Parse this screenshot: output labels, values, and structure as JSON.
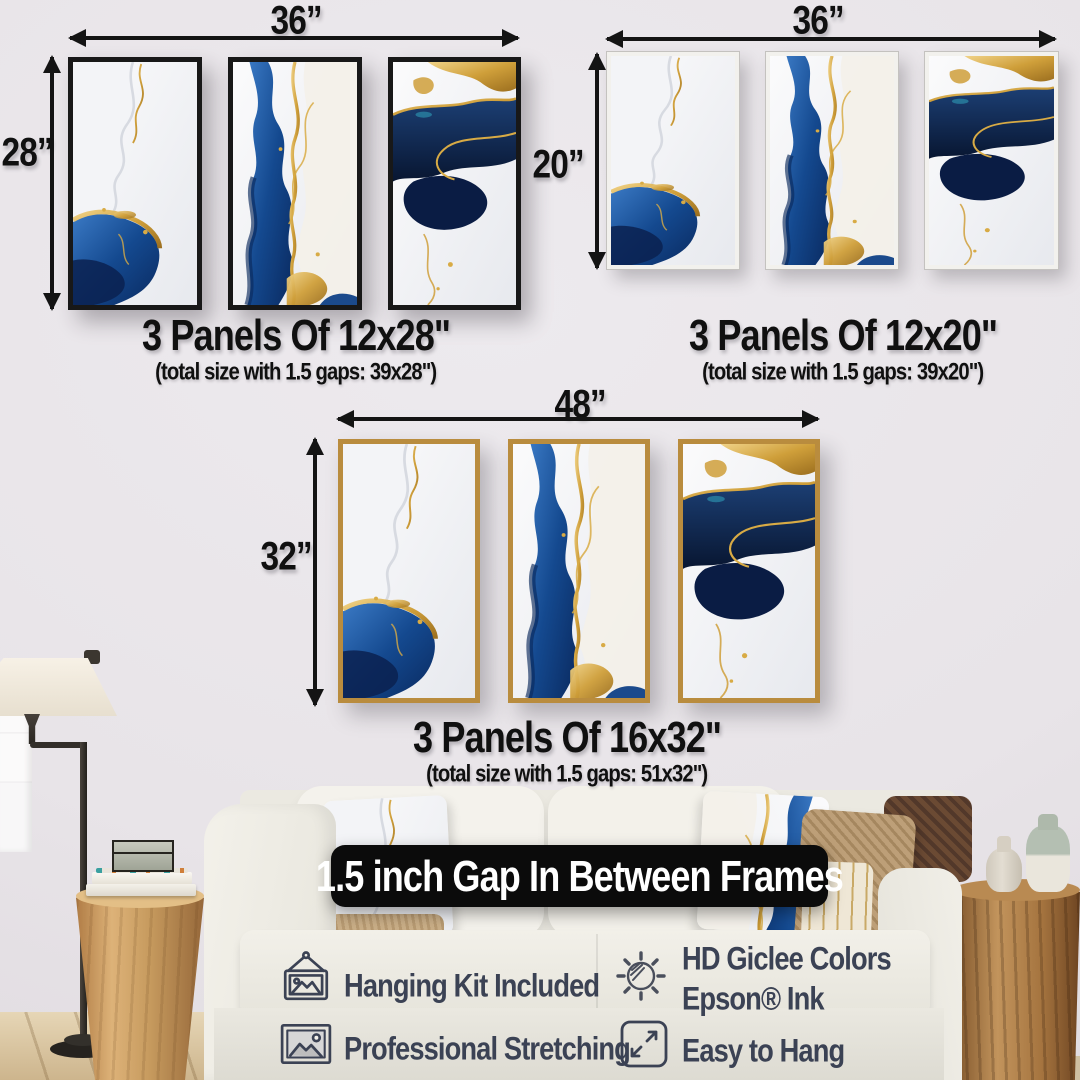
{
  "sets": [
    {
      "width_label": "36”",
      "height_label": "28”",
      "title": "3 Panels Of 12x28\"",
      "subtitle": "(total size with 1.5 gaps: 39x28\")",
      "frame_style": "black"
    },
    {
      "width_label": "36”",
      "height_label": "20”",
      "title": "3 Panels Of 12x20\"",
      "subtitle": "(total size with 1.5 gaps: 39x20\")",
      "frame_style": "white"
    },
    {
      "width_label": "48”",
      "height_label": "32”",
      "title": "3 Panels Of 16x32\"",
      "subtitle": "(total size with 1.5 gaps: 51x32\")",
      "frame_style": "gold"
    }
  ],
  "banner": {
    "text": "1.5 inch Gap In Between Frames"
  },
  "features": {
    "left": [
      {
        "icon": "hanging-frame-icon",
        "label": "Hanging Kit Included"
      },
      {
        "icon": "image-frame-icon",
        "label": "Professional Stretching"
      }
    ],
    "right": [
      {
        "icon": "giclee-ink-icon",
        "line1": "HD Giclee Colors",
        "line2": "Epson® Ink"
      },
      {
        "icon": "expand-arrows-icon",
        "line1": "Easy to Hang"
      }
    ]
  },
  "colors": {
    "wall": "#e8e4e8",
    "frame_black": "#181818",
    "frame_white": "#f2f1ed",
    "frame_gold": "#b98c3e",
    "art_blue": "#14498f",
    "art_navy": "#0a1c44",
    "art_gold": "#c89b3e",
    "caption_text": "#101010",
    "feature_text": "#3b4254",
    "banner_bg": "#0b0b0b",
    "banner_text": "#ffffff"
  }
}
